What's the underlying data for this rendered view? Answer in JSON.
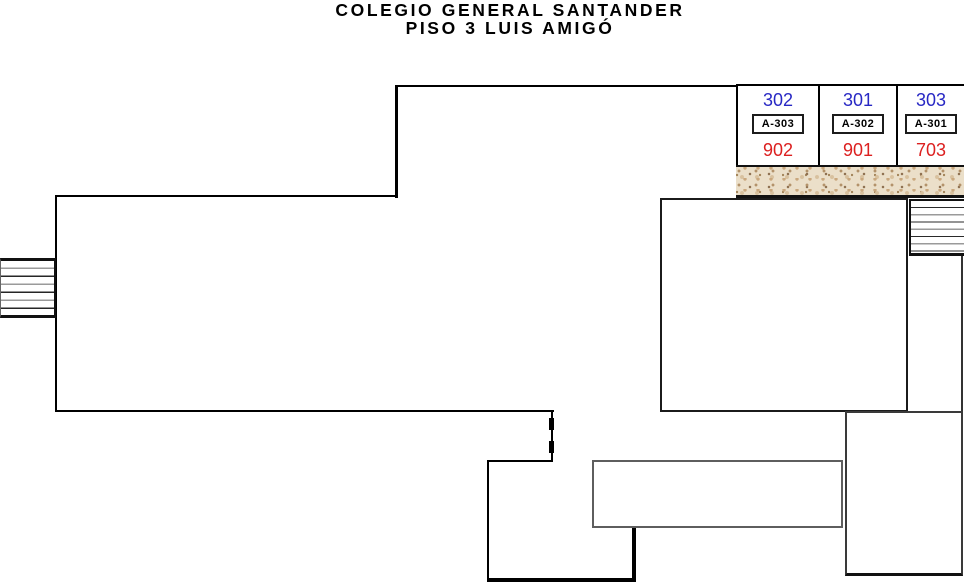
{
  "title": {
    "line1": "COLEGIO GENERAL SANTANDER",
    "line2": "PISO 3 LUIS AMIGÓ"
  },
  "classrooms": [
    {
      "room_number": "302",
      "door_code": "A-303",
      "internal_code": "902"
    },
    {
      "room_number": "301",
      "door_code": "A-302",
      "internal_code": "901"
    },
    {
      "room_number": "303",
      "door_code": "A-301",
      "internal_code": "703"
    }
  ],
  "colors": {
    "room_number_blue": "#2828C4",
    "internal_code_red": "#DC2020",
    "walls": "#000000",
    "texture_base": "#EBDFC9",
    "texture_speckle": "#B3926A"
  },
  "legend": {
    "left_stairs": "stairs",
    "right_stairs": "stairs",
    "texture_band": "wall-hatch"
  }
}
